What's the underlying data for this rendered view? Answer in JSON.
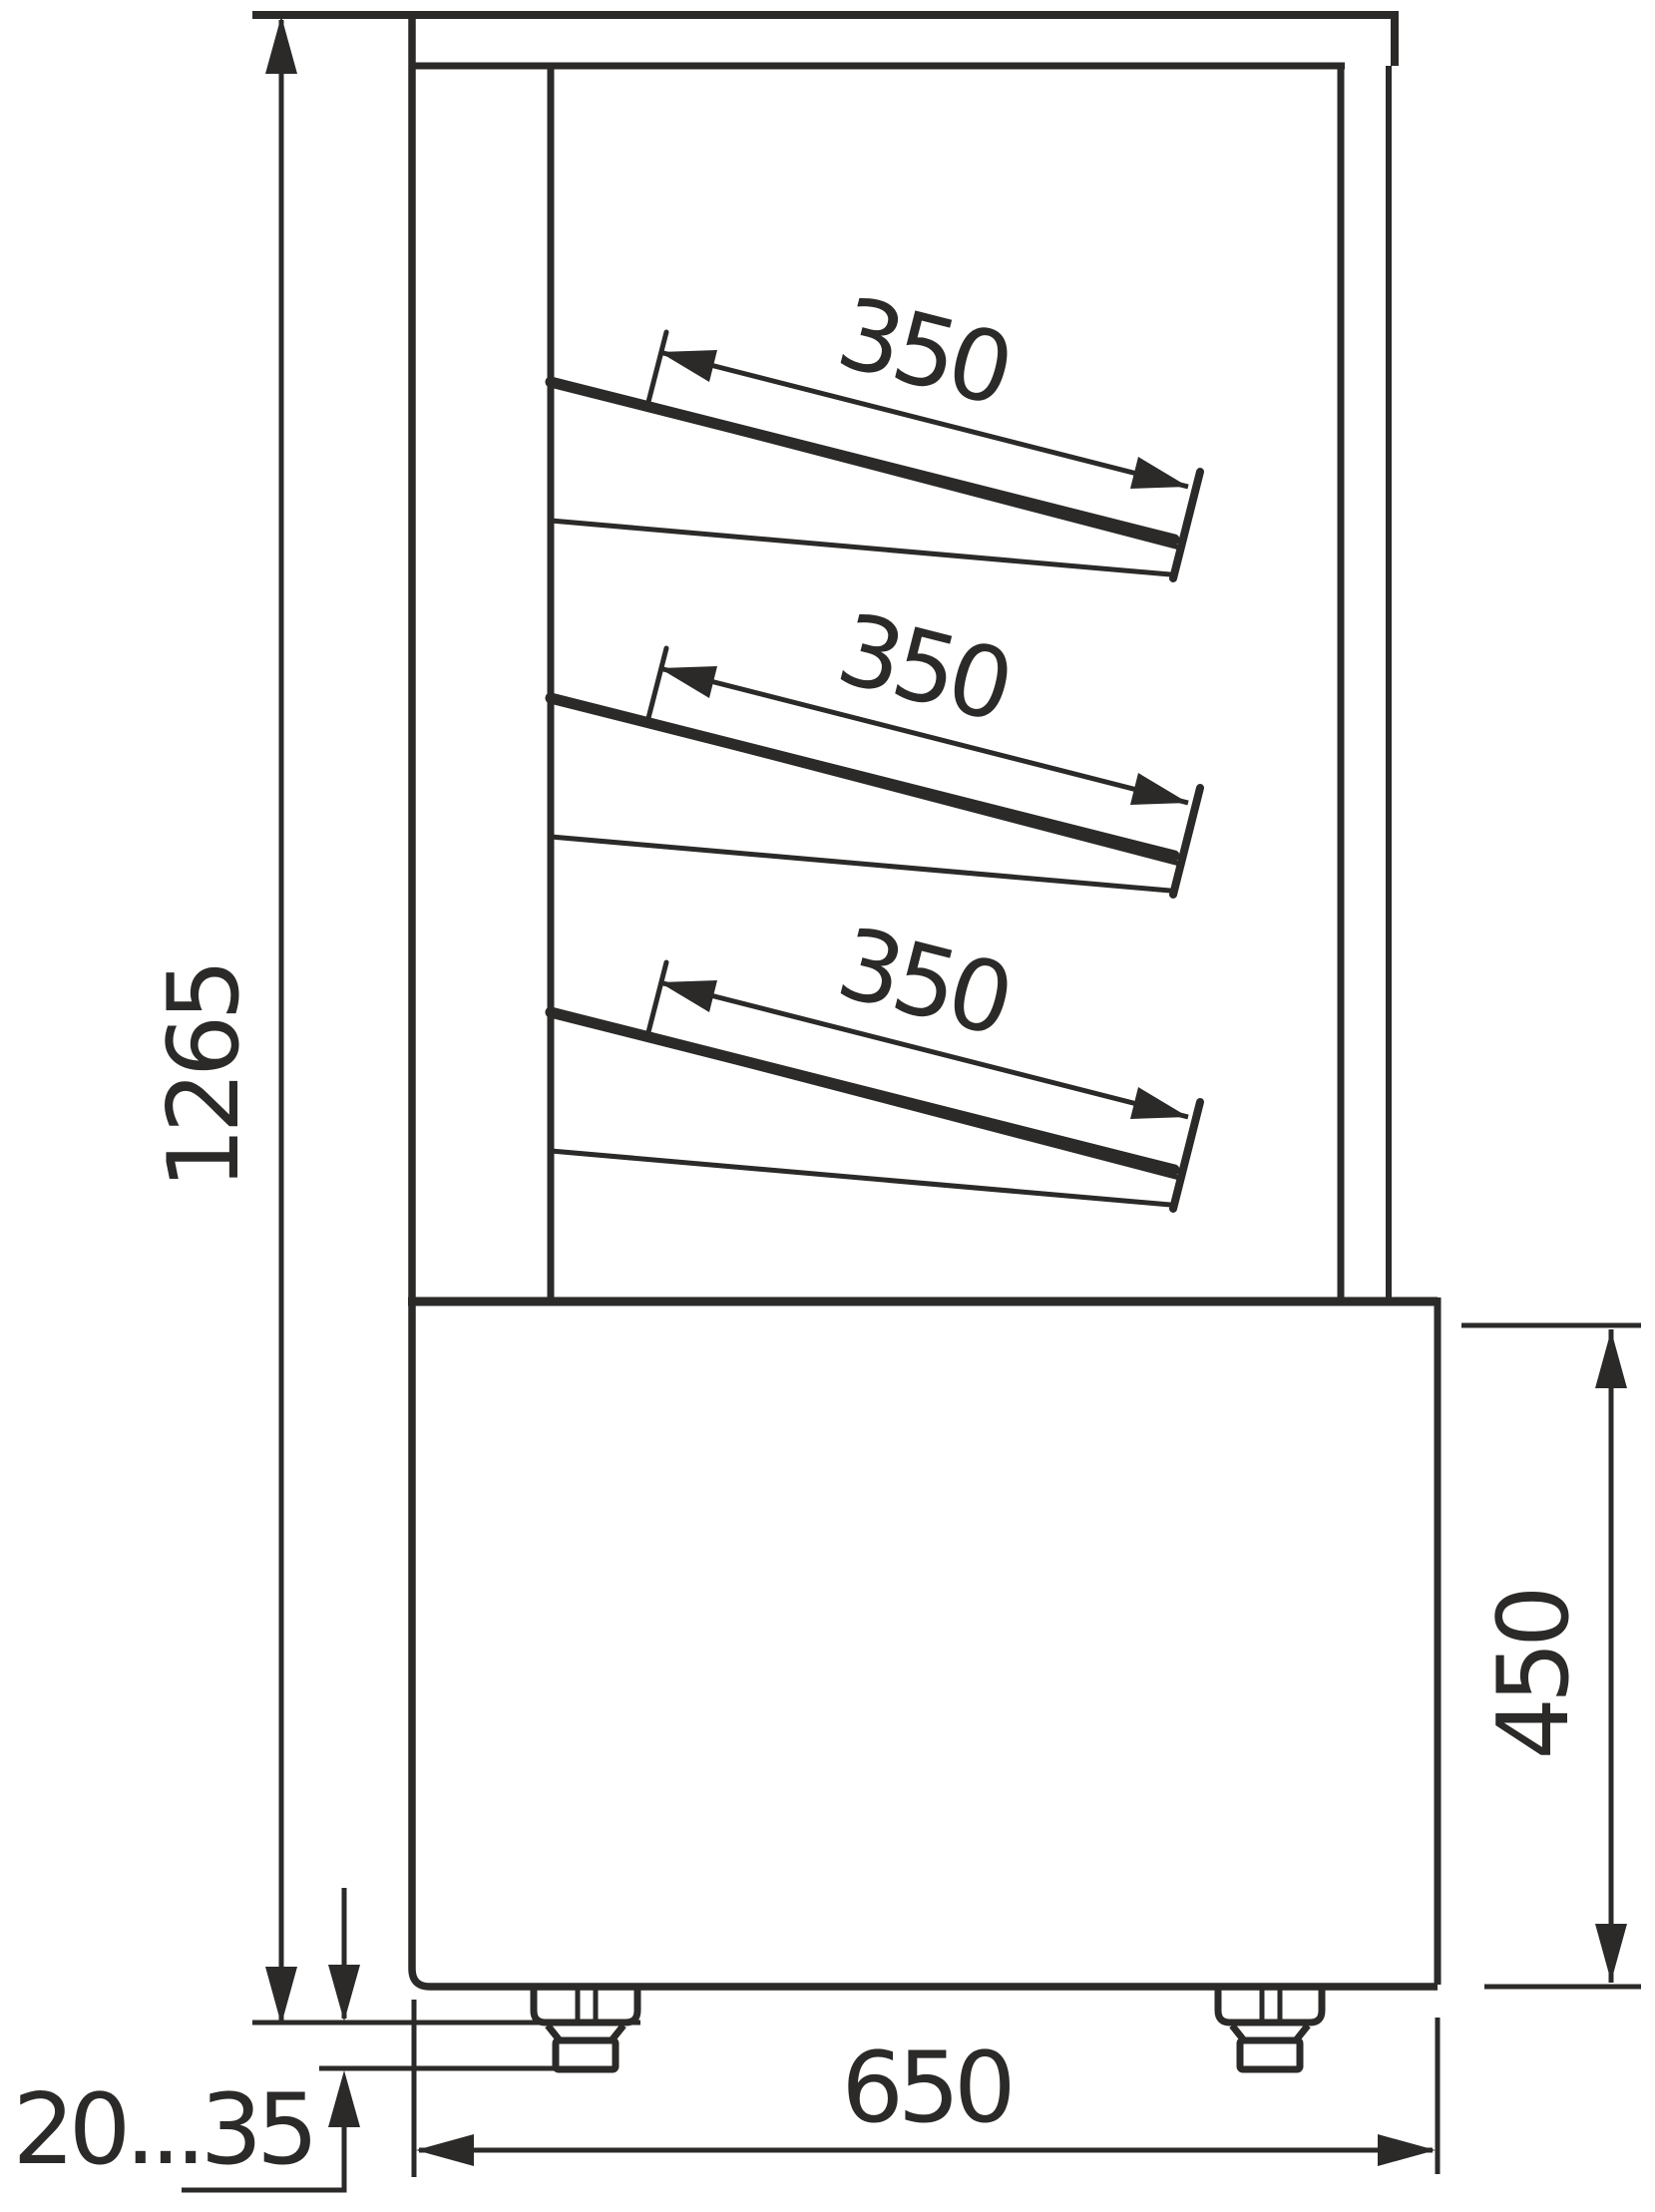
{
  "drawing": {
    "kind": "technical-dimension-drawing",
    "line_color": "#2b2a29",
    "background_color": "#ffffff",
    "dimensions": {
      "overall_height": "1265",
      "base_height": "450",
      "base_width": "650",
      "foot_adjustment_range": "20...35"
    },
    "shelves": [
      {
        "depth": "350"
      },
      {
        "depth": "350"
      },
      {
        "depth": "350"
      }
    ]
  }
}
